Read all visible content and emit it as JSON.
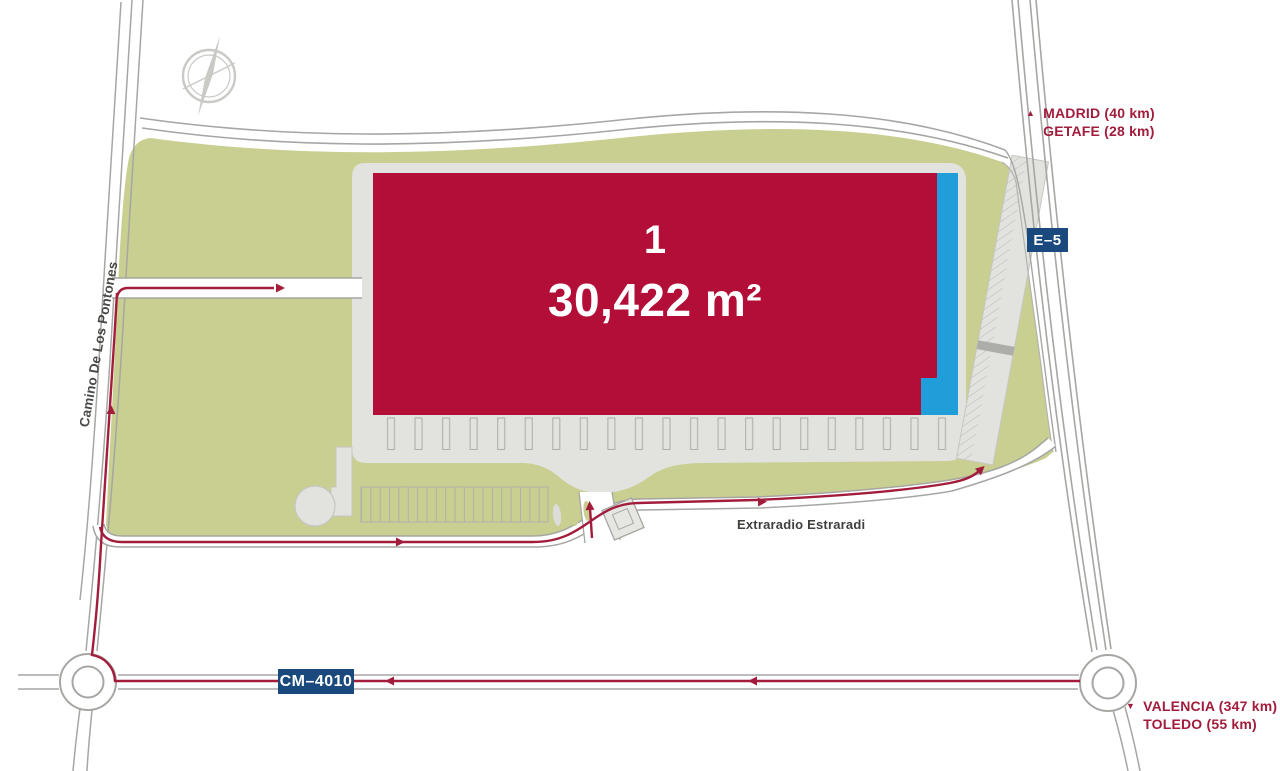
{
  "building": {
    "number": "1",
    "area": "30,422 m²"
  },
  "labels": {
    "left_road": "Camino De Los Pontones",
    "inner_street": "Extraradio Estraradi"
  },
  "badges": {
    "right_highway": "E–5",
    "bottom_highway": "CM–4010"
  },
  "destinations": {
    "north": [
      "MADRID (40 km)",
      "GETAFE (28 km)"
    ],
    "south": [
      "VALENCIA (347 km)",
      "TOLEDO (55 km)"
    ]
  },
  "colors": {
    "building_red": "#b20e38",
    "dock_blue": "#1f9ed9",
    "green": "#c9cf90",
    "pavement": "#e2e2df",
    "road_line": "#a6a6a3",
    "route_red": "#a21d3c",
    "badge_navy": "#1a4a7d",
    "street_label": "#3f3f3e"
  }
}
